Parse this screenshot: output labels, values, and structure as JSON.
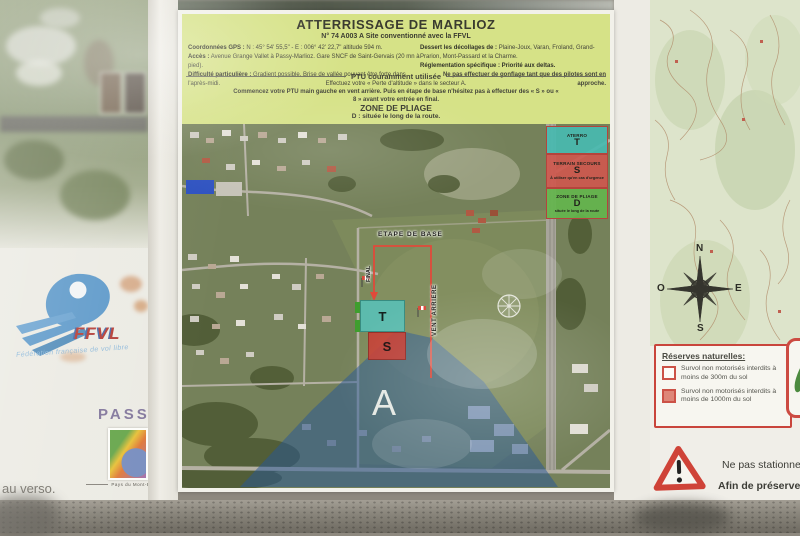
{
  "poster": {
    "title": "ATTERRISSAGE DE MARLIOZ",
    "subtitle": "N° 74 A003 A Site conventionné avec la FFVL",
    "info": {
      "gps_label": "Coordonnées GPS :",
      "gps_text": " N : 45° 54' 55,5\" - E : 006° 42' 22,7\" altitude 594 m.",
      "acces_label": "Accès :",
      "acces_text": " Avenue Grange Vallet à Passy-Marlioz. Gare SNCF de Saint-Gervais (20 mn à pied).",
      "difficulte_label": "Difficulté particulière :",
      "difficulte_text": " Gradient possible. Brise de vallée pouvant être forte dans l'après-midi.",
      "dessert_label": "Dessert les décollages de :",
      "dessert_text": " Plaine-Joux, Varan, Froland, Grand-Prarion, Mont-Passard et la Charme.",
      "reglementation_label": "Réglementation spécifique :",
      "reglementation_text": " Priorité aux deltas.",
      "reglementation_note": "Ne pas effectuer de gonflage tant que des pilotes sont en approche."
    },
    "ptu": {
      "divider": "PTU couramment utilisée",
      "line1": "Effectuez votre « Perte d'altitude » dans le secteur A.",
      "line2": "Commencez votre PTU main gauche en vent arrière. Puis en étape de base n'hésitez pas à effectuer des « S » ou « 8 » avant votre entrée en final."
    },
    "pliage": {
      "title": "ZONE DE PLIAGE",
      "text": "D : située le long de la route."
    }
  },
  "legend": {
    "aterro": {
      "name": "ATERRO",
      "letter": "T"
    },
    "secours": {
      "name": "TERRAIN SECOURS",
      "letter": "S",
      "note": "À utiliser qu'en cas d'urgence"
    },
    "pliage": {
      "name": "ZONE DE PLIAGE",
      "letter": "D",
      "note": "située le long de la route"
    }
  },
  "map": {
    "etape_de_base": "ETAPE DE BASE",
    "final": "FINAL",
    "vent_arriere": "VENT ARRIERE",
    "sector_a": "A",
    "zone_t": "T",
    "zone_s": "S"
  },
  "compass": {
    "north": "N",
    "south": "S",
    "east": "E",
    "west": "O"
  },
  "reserves": {
    "title": "Réserves naturelles:",
    "item1": "Survol non motorisés interdits à moins de 300m du sol",
    "item2": "Survol non motorisés interdits à moins de 1000m du sol"
  },
  "warning": {
    "line1": "Ne pas stationner s",
    "line2": "Afin de préserver n"
  },
  "left_panel": {
    "ffvl": "FFVL",
    "ffvl_subtitle": "Fédération française de vol libre",
    "passy": "PASSY",
    "passy_subtitle": "Pays du Mont-Blanc",
    "verso": "au verso."
  },
  "colors": {
    "header_green": "#d6e287",
    "zone_t_teal": "#58c2b8",
    "zone_s_red": "#c63e34",
    "zone_d_green": "#64b54d",
    "sector_a_blue": "#265698",
    "path_red": "#e04a3a",
    "reserve_red": "#cc4b42"
  }
}
